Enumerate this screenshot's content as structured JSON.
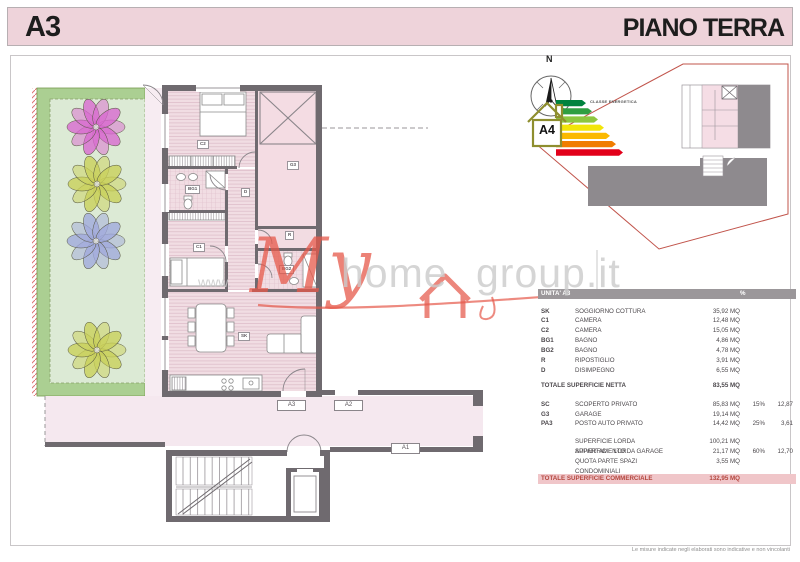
{
  "header": {
    "unit": "A3",
    "floor": "PIANO TERRA"
  },
  "compass": {
    "north": "N",
    "icon": "compass-rose-icon"
  },
  "energy": {
    "class": "A4",
    "title": "CLASSE ENERGETICA",
    "house_icon": "energy-house-icon",
    "scale_colors": [
      "#00833e",
      "#2f9e41",
      "#8dc63f",
      "#f2e50a",
      "#fbb900",
      "#f07d00",
      "#e2001a"
    ]
  },
  "watermark": {
    "prefix": "www.",
    "part1": "My",
    "part2": "home",
    "part3": "group.it",
    "house_icon": "house-outline-icon",
    "color": "#e5584a"
  },
  "plan": {
    "room_labels": [
      "C2",
      "G3",
      "BG1",
      "D",
      "C1",
      "R",
      "BG2",
      "SK"
    ],
    "door_labels": [
      "A3",
      "A2",
      "A1"
    ],
    "wall_color": "#6f6a6f",
    "floor_color": "#f1dde3",
    "garden_color": "#dcead5",
    "hedge_color": "#abcf92",
    "corridor_color": "#f5e8ef",
    "flower_colors": [
      "#d967d0",
      "#c9cf57",
      "#9fa8dc",
      "#c9cf57"
    ]
  },
  "table": {
    "head": {
      "title": "UNITA' A3",
      "pct": "%"
    },
    "rows": [
      {
        "code": "SK",
        "name": "SOGGIORNO COTTURA",
        "area": "35,92 MQ"
      },
      {
        "code": "C1",
        "name": "CAMERA",
        "area": "12,48 MQ"
      },
      {
        "code": "C2",
        "name": "CAMERA",
        "area": "15,05 MQ"
      },
      {
        "code": "BG1",
        "name": "BAGNO",
        "area": "4,86 MQ"
      },
      {
        "code": "BG2",
        "name": "BAGNO",
        "area": "4,78 MQ"
      },
      {
        "code": "R",
        "name": "RIPOSTIGLIO",
        "area": "3,91 MQ"
      },
      {
        "code": "D",
        "name": "DISIMPEGNO",
        "area": "6,55 MQ"
      }
    ],
    "net_total": {
      "label": "TOTALE SUPERFICIE NETTA",
      "area": "83,55 MQ"
    },
    "private_rows": [
      {
        "code": "SC",
        "name": "SCOPERTO PRIVATO",
        "area": "85,83 MQ",
        "pct": "15%",
        "val": "12,87"
      },
      {
        "code": "G3",
        "name": "GARAGE",
        "area": "19,14 MQ",
        "pct": "",
        "val": ""
      },
      {
        "code": "PA3",
        "name": "POSTO AUTO PRIVATO",
        "area": "14,42 MQ",
        "pct": "25%",
        "val": "3,61"
      }
    ],
    "gross_rows": [
      {
        "name": "SUPERFICIE LORDA APPARTAMENTO",
        "area": "100,21 MQ",
        "pct": "",
        "val": ""
      },
      {
        "name": "SUPERFICIE LORDA GARAGE",
        "area": "21,17 MQ",
        "pct": "60%",
        "val": "12,70"
      },
      {
        "name": "QUOTA PARTE SPAZI CONDOMINIALI",
        "area": "3,55 MQ",
        "pct": "",
        "val": ""
      }
    ],
    "total": {
      "label": "TOTALE SUPERFICIE COMMERCIALE",
      "area": "132,95 MQ"
    }
  },
  "footer": {
    "disclaimer": "Le misure indicate negli elaborati sono indicative e non vincolanti"
  }
}
